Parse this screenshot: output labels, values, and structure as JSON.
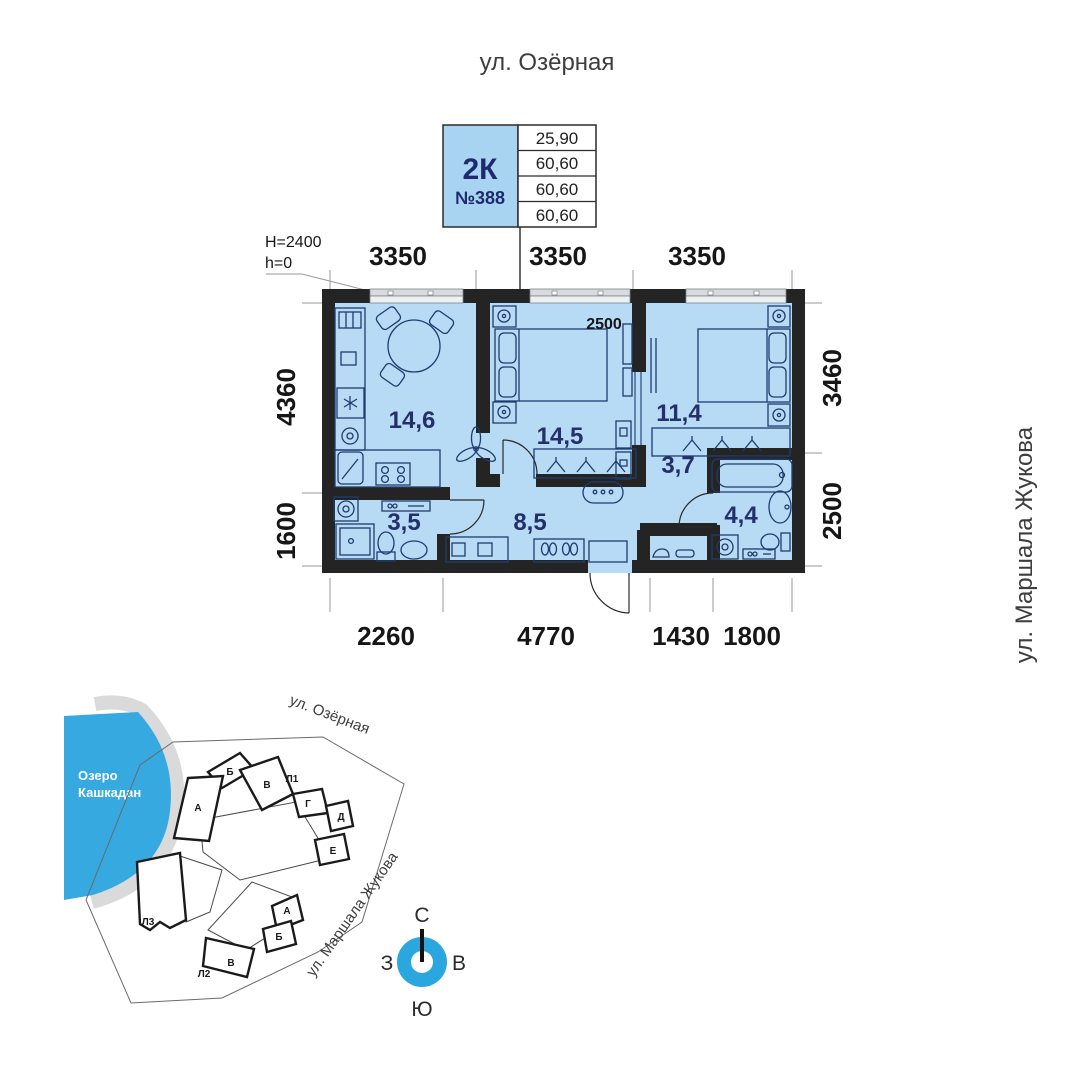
{
  "header": {
    "street_top": "ул. Озёрная",
    "street_right": "ул. Маршала Жукова"
  },
  "info_box": {
    "type": "2К",
    "number": "№388",
    "rows": [
      "25,90",
      "60,60",
      "60,60",
      "60,60"
    ]
  },
  "plan": {
    "notes": {
      "h": "H=2400",
      "h_small": "h=0"
    },
    "inner_dim": "2500",
    "dims": {
      "top": [
        "3350",
        "3350",
        "3350"
      ],
      "left": [
        "4360",
        "1600"
      ],
      "right": [
        "3460",
        "2500"
      ],
      "bottom": [
        "2260",
        "4770",
        "1430",
        "1800"
      ]
    },
    "rooms": [
      {
        "name": "kitchen-living",
        "area": "14,6"
      },
      {
        "name": "bedroom-1",
        "area": "14,5"
      },
      {
        "name": "bedroom-2",
        "area": "11,4"
      },
      {
        "name": "corridor",
        "area": "3,7"
      },
      {
        "name": "bathroom",
        "area": "4,4"
      },
      {
        "name": "wc",
        "area": "3,5"
      },
      {
        "name": "hallway",
        "area": "8,5"
      }
    ]
  },
  "site_plan": {
    "lake": {
      "line1": "Озеро",
      "line2": "Кашкадан"
    },
    "streets": {
      "ozernaya": "ул. Озёрная",
      "zhukova": "ул. Маршала Жукова"
    },
    "buildings": {
      "l1": "Л1",
      "l2": "Л2",
      "l3": "Л3"
    },
    "l1_sections": [
      "Б",
      "А",
      "В",
      "Г",
      "Д",
      "Е"
    ],
    "l2_sections": [
      "А",
      "Б",
      "В"
    ]
  },
  "compass": {
    "north": "С",
    "south": "Ю",
    "west": "З",
    "east": "В"
  },
  "colors": {
    "apartment_fill": "#b7daf5",
    "wall": "#242424",
    "accent_navy": "#233069",
    "lake_blue": "#36a9e1",
    "compass_blue": "#2ba7e0",
    "info_cell_blue": "#a9d4f1",
    "highlight_section": "#c9c9c9"
  }
}
